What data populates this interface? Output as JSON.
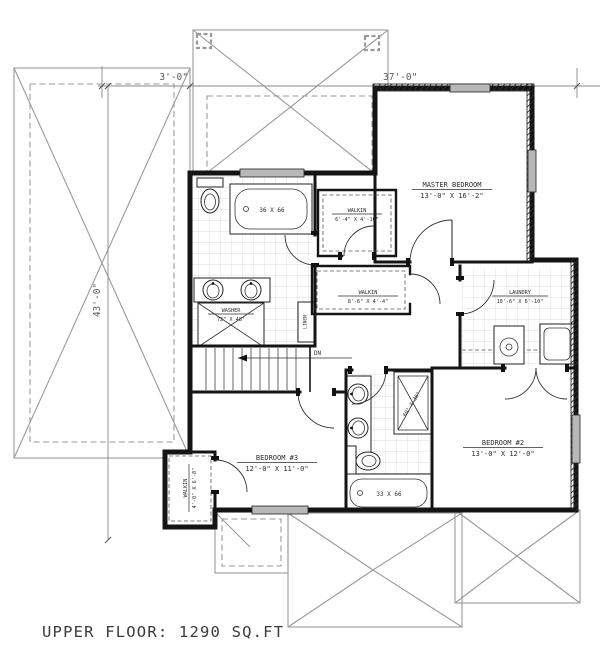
{
  "title": "UPPER FLOOR: 1290 SQ.FT",
  "dimensions": {
    "overhang": "3'-0\"",
    "width": "37'-0\"",
    "depth": "43'-0\""
  },
  "rooms": {
    "master": {
      "name": "MASTER BEDROOM",
      "size": "13'-0\" X 16'-2\""
    },
    "walkin_master_a": {
      "name": "WALKIN",
      "size": "6'-4\" X 4'-10\""
    },
    "walkin_master_b": {
      "name": "WALKIN",
      "size": "8'-6\" X 4'-4\""
    },
    "laundry": {
      "name": "LAUNDRY",
      "size": "10'-6\" X 6'-10\""
    },
    "bedroom2": {
      "name": "BEDROOM #2",
      "size": "13'-0\" X 12'-0\""
    },
    "bedroom3": {
      "name": "BEDROOM #3",
      "size": "12'-0\" X 11'-0\""
    },
    "walkin_bedroom3": {
      "name": "WALKIN",
      "size": "4'-0\" X 6'-8\""
    }
  },
  "fixtures": {
    "tub_master": "36 X 66",
    "tub_shared": "33 X 66",
    "shower": "60\" X 36\"",
    "washer_name": "WASHER",
    "washer_size": "72\" X 48\"",
    "linen": "LINEN",
    "stair_direction": "DN"
  },
  "colors": {
    "bg": "#ffffff",
    "wall": "#141414",
    "roof": "#9a9a9a",
    "dim": "#8a8a8a",
    "dim-text": "#5a5a5a",
    "text": "#2e2e2e",
    "window": "#b8b8b8"
  }
}
